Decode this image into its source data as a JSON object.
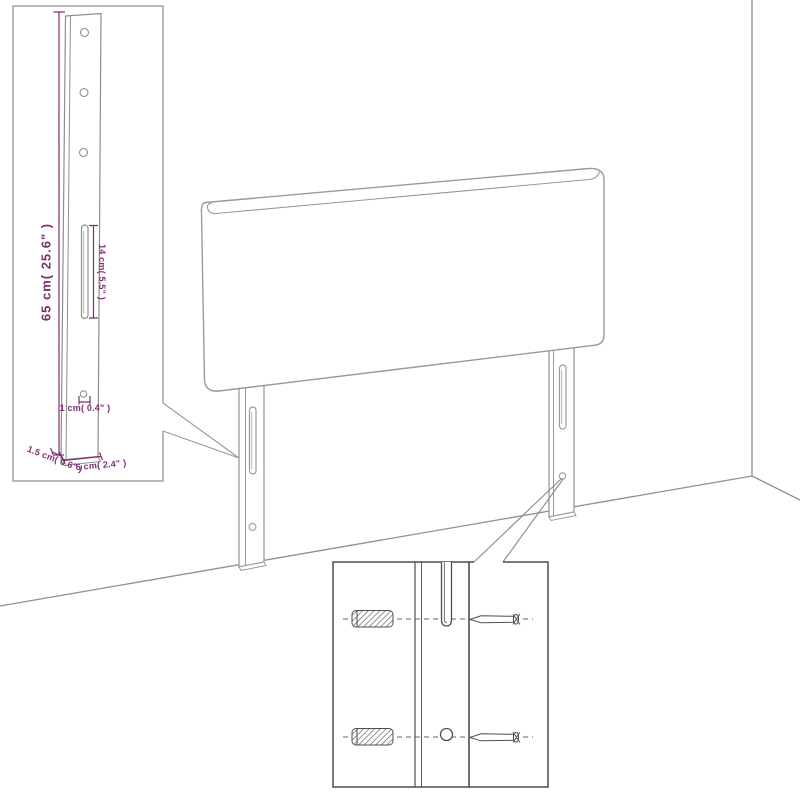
{
  "diagram": {
    "type": "furniture-assembly-dimension-diagram",
    "colors": {
      "background": "#ffffff",
      "dimension_text": "#7d2f73",
      "main_outline": "#9a9a9a",
      "inset_outline": "#8e8e8e",
      "detail_outline": "#4f4f4f",
      "wall_line": "#8f8f8f"
    },
    "labels": {
      "leg_height": "65 cm( 25.6\" )",
      "slot_length": "14 cm( 5.5\" )",
      "hole_diameter": "1 cm( 0.4\" )",
      "leg_thickness": "1.5 cm( 0.6\" )",
      "leg_width": "6 cm( 2.4\" )"
    }
  }
}
